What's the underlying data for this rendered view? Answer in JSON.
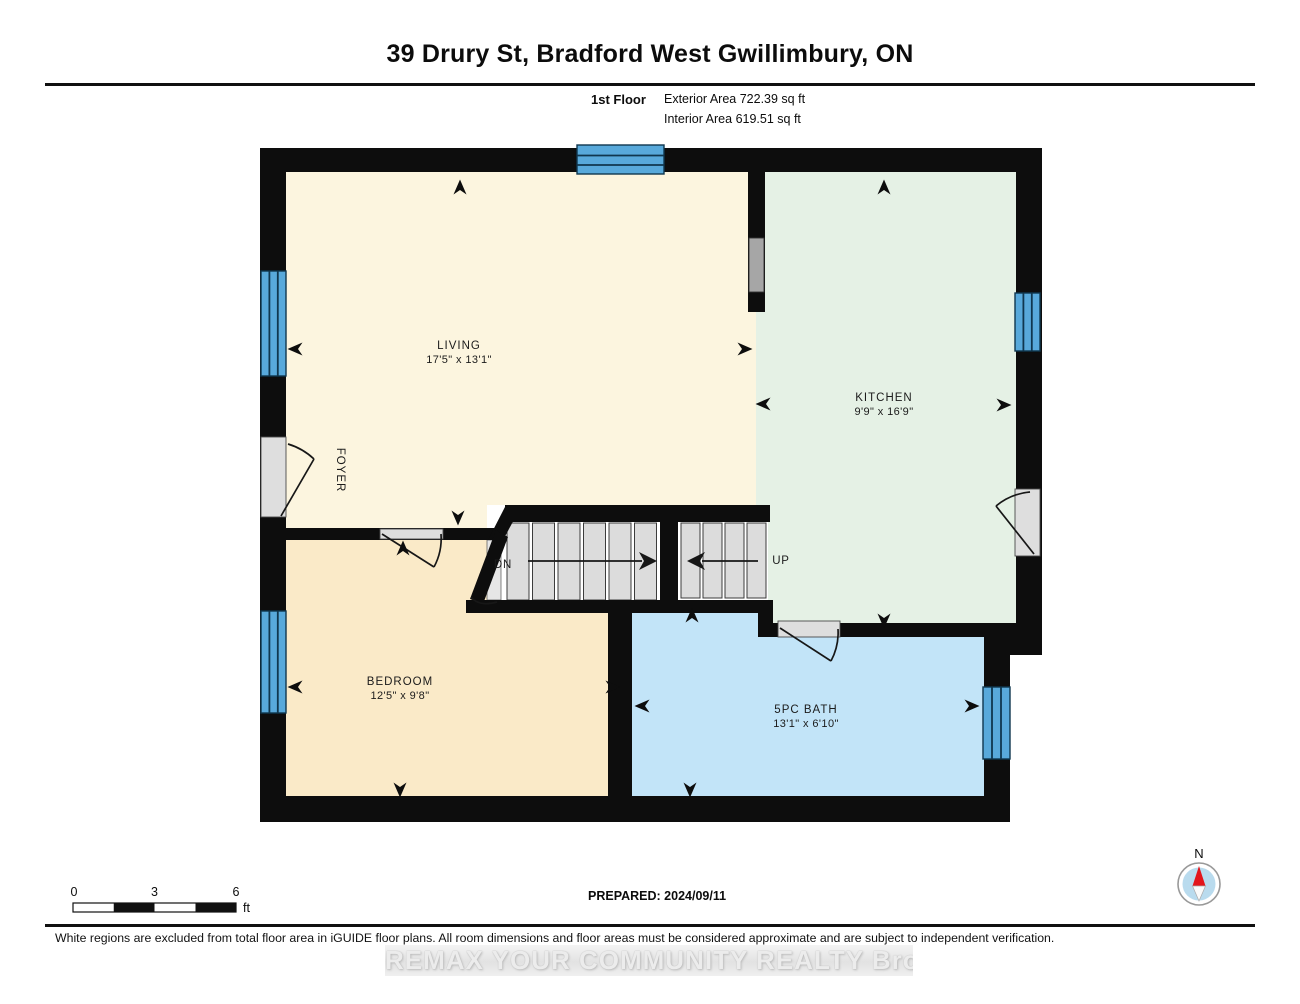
{
  "header": {
    "title": "39 Drury St, Bradford West Gwillimbury, ON",
    "floor_label": "1st Floor",
    "exterior_area": "Exterior Area 722.39 sq ft",
    "interior_area": "Interior Area 619.51 sq ft"
  },
  "plan": {
    "rooms": {
      "living": {
        "name": "LIVING",
        "dims": "17'5\" x 13'1\""
      },
      "kitchen": {
        "name": "KITCHEN",
        "dims": "9'9\" x 16'9\""
      },
      "bedroom": {
        "name": "BEDROOM",
        "dims": "12'5\" x 9'8\""
      },
      "bath": {
        "name": "5PC BATH",
        "dims": "13'1\" x 6'10\""
      },
      "foyer": {
        "name": "FOYER"
      }
    },
    "stairs": {
      "down_label": "DN",
      "up_label": "UP"
    },
    "arrows": [
      {
        "x": 460,
        "y": 188,
        "dir": "up"
      },
      {
        "x": 884,
        "y": 188,
        "dir": "up"
      },
      {
        "x": 296,
        "y": 349,
        "dir": "left"
      },
      {
        "x": 744,
        "y": 349,
        "dir": "right"
      },
      {
        "x": 764,
        "y": 404,
        "dir": "left"
      },
      {
        "x": 1003,
        "y": 405,
        "dir": "right"
      },
      {
        "x": 458,
        "y": 517,
        "dir": "down"
      },
      {
        "x": 403,
        "y": 549,
        "dir": "up"
      },
      {
        "x": 296,
        "y": 687,
        "dir": "left"
      },
      {
        "x": 612,
        "y": 687,
        "dir": "right"
      },
      {
        "x": 643,
        "y": 706,
        "dir": "left"
      },
      {
        "x": 971,
        "y": 706,
        "dir": "right"
      },
      {
        "x": 692,
        "y": 616,
        "dir": "up"
      },
      {
        "x": 884,
        "y": 620,
        "dir": "down"
      },
      {
        "x": 400,
        "y": 789,
        "dir": "down"
      },
      {
        "x": 690,
        "y": 789,
        "dir": "down"
      }
    ]
  },
  "scale_bar": {
    "t0": "0",
    "t3": "3",
    "t6": "6",
    "unit": "ft"
  },
  "prepared": "PREPARED: 2024/09/11",
  "compass": {
    "north_label": "N"
  },
  "footer": {
    "disclaimer": "White regions are excluded from total floor area in iGUIDE floor plans. All room dimensions and floor areas must be considered approximate and are subject to independent verification.",
    "watermark": "REMAX YOUR COMMUNITY REALTY  Brokerage"
  },
  "theme": {
    "wall": "#0d0d0d",
    "living": "#FCF5DF",
    "kitchen": "#E5F1E5",
    "bedroom": "#FAEAC8",
    "bath": "#C2E4F8",
    "window": "#58A9DB",
    "tread": "#DCDCDC",
    "tread_line": "#3c3c3c",
    "recess": "#DEDEDE",
    "passthrough": "#A6A6A6",
    "compass_disc": "#B9DBEE",
    "compass_red": "#E3151B"
  }
}
